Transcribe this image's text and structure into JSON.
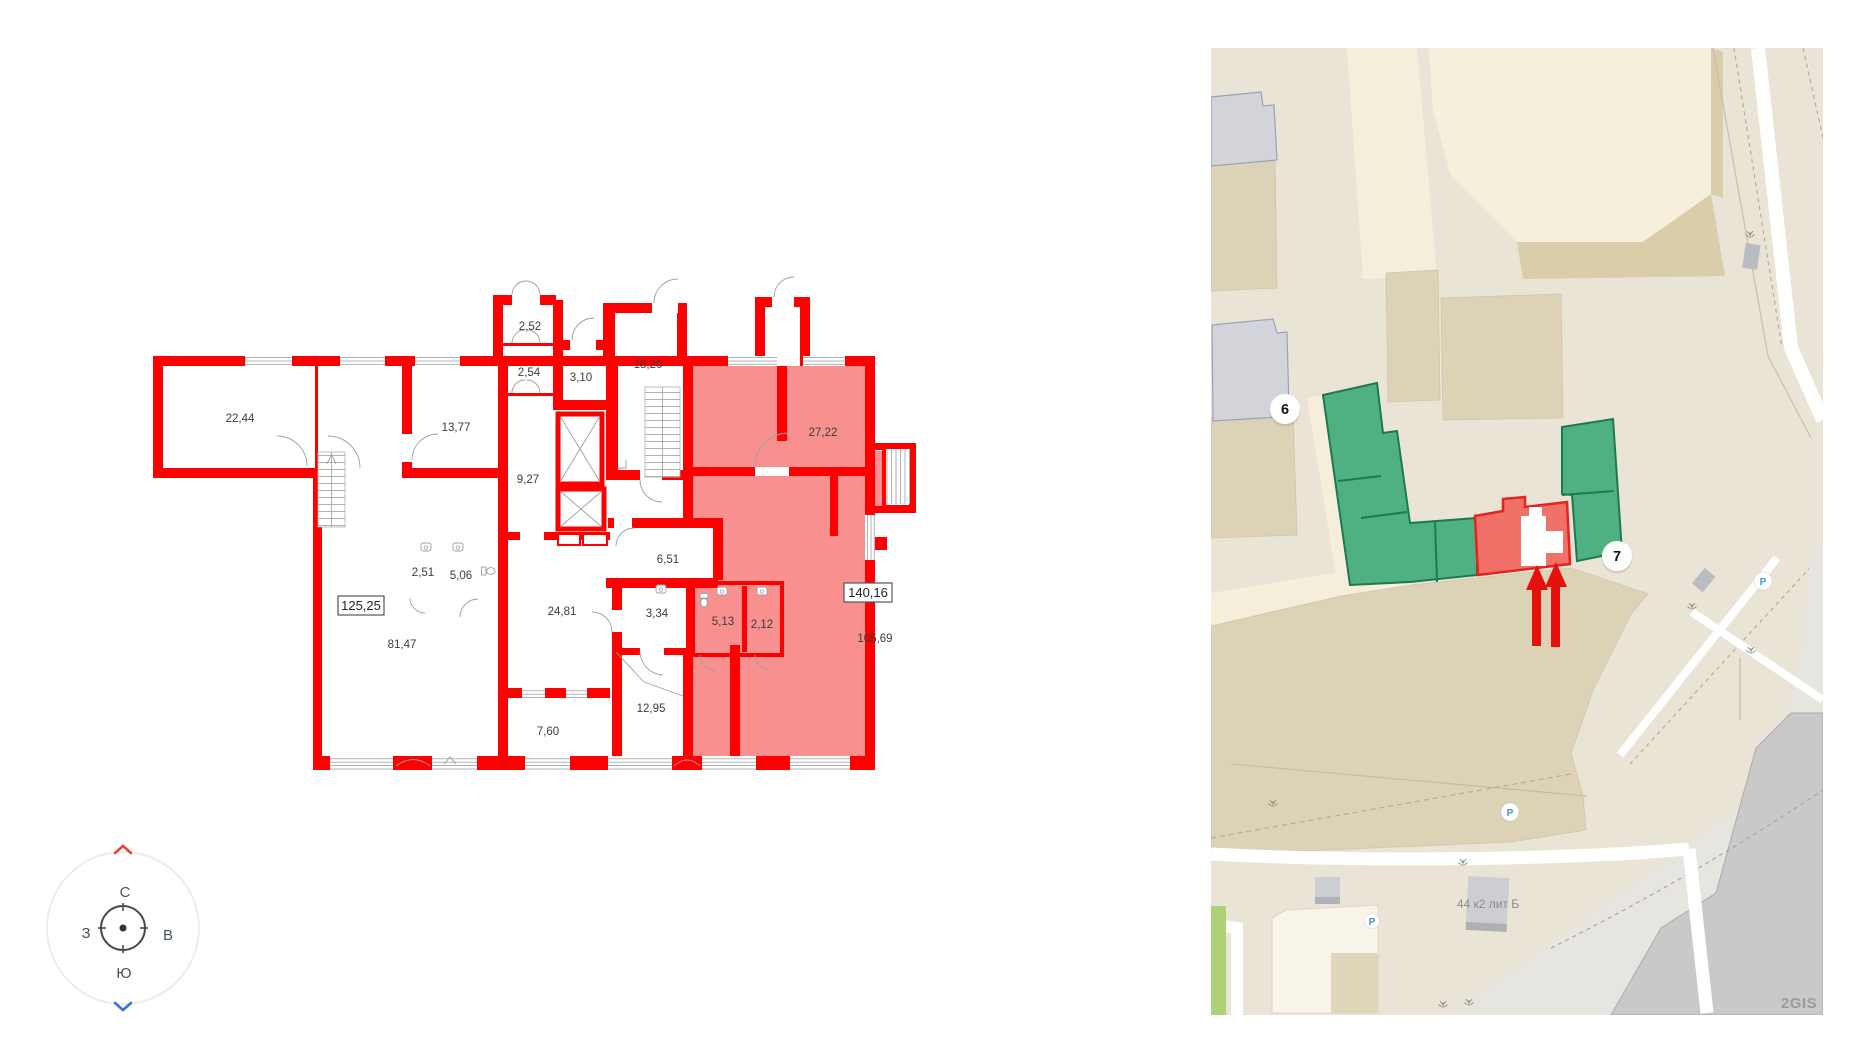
{
  "floor_plan": {
    "rooms": [
      "22,44",
      "13,77",
      "2,52",
      "2,54",
      "3,10",
      "18,20",
      "9,27",
      "27,22",
      "2,51",
      "5,06",
      "6,51",
      "81,47",
      "24,81",
      "3,34",
      "5,13",
      "2,12",
      "105,69",
      "12,95",
      "7,60"
    ],
    "unit_left_total": "125,25",
    "unit_right_total": "140,16",
    "compass": {
      "north": "С",
      "south": "Ю",
      "west": "З",
      "east": "В"
    },
    "colors": {
      "wall_red": "#ff0000",
      "highlight_pink": "#f99090",
      "line_gray": "#9aa0a6"
    }
  },
  "map": {
    "markers": [
      "6",
      "7"
    ],
    "building_label": "44 к2 лит Б",
    "watermark": "2GIS",
    "parking_label": "P",
    "colors": {
      "base_beige": "#eae4d6",
      "block_beige": "#dcd2b6",
      "road_pale": "#f4eeda",
      "building_pale": "#f5efdc",
      "building_shadow": "#d9cdaa",
      "building_green": "#4fb083",
      "green_outline": "#1d7a4e",
      "highlight_red": "#ef7168",
      "highlight_outline": "#e6231c",
      "arrow_red": "#e8100c",
      "gray_building": "#d2d4d9",
      "gray_outline": "#97a2ba",
      "industrial_gray": "#c9c9c9",
      "ground_gray": "#e7e5e0",
      "grass_green": "#aed177",
      "parking_blue": "#3f96d2"
    }
  }
}
